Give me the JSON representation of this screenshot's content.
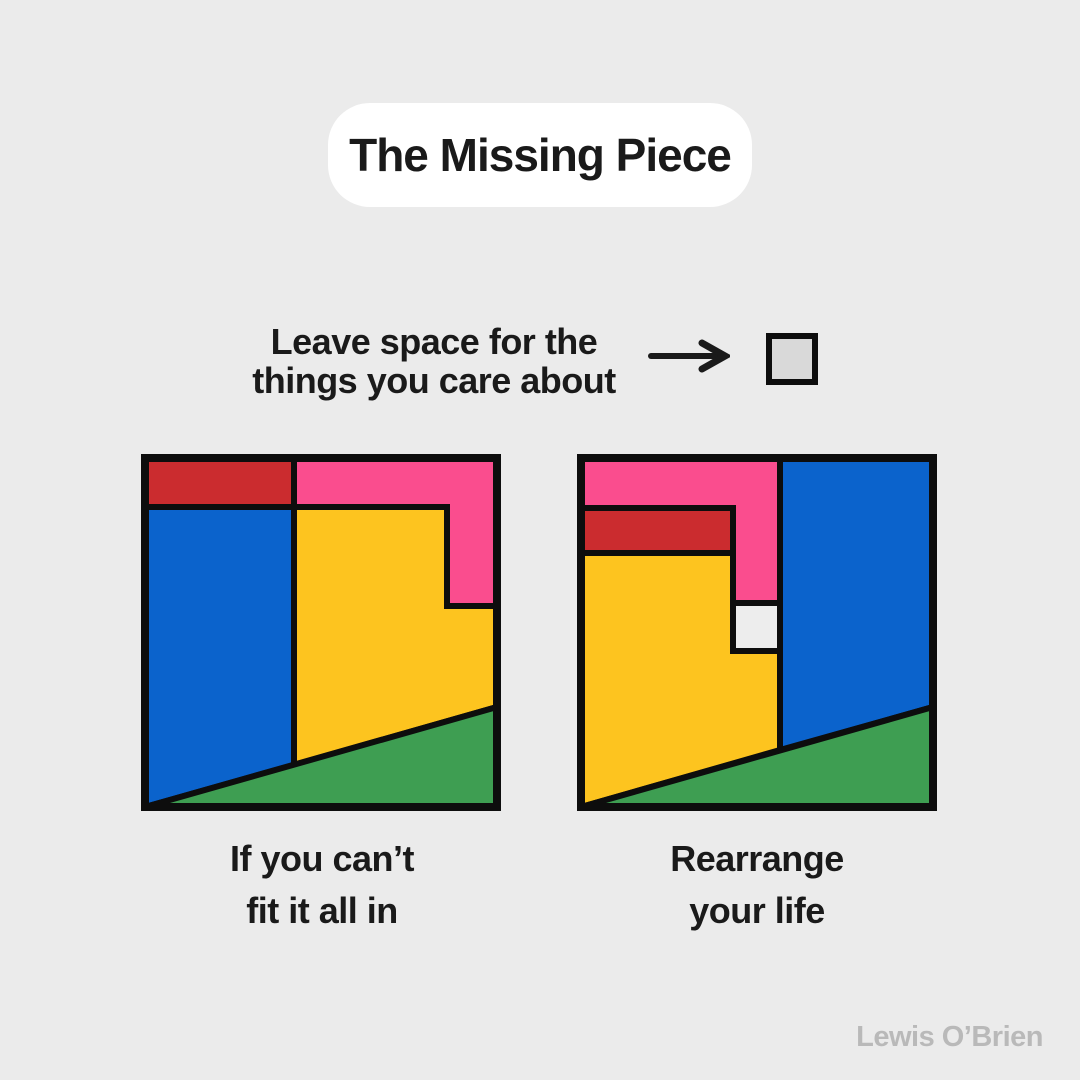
{
  "title": "The Missing Piece",
  "instruction": {
    "line1": "Leave space for the",
    "line2": "things you care about"
  },
  "panels": {
    "left": {
      "caption_line1": "If you can’t",
      "caption_line2": "fit it all in"
    },
    "right": {
      "caption_line1": "Rearrange",
      "caption_line2": "your life"
    }
  },
  "signature": "Lewis O’Brien",
  "palette": {
    "background": "#ebebeb",
    "card": "#ffffff",
    "ink": "#1a1a1a",
    "outline": "#0d0d0d",
    "red": "#cb2c2f",
    "pink": "#fa4d8e",
    "blue": "#0b63cc",
    "yellow": "#fdc41f",
    "green": "#3e9e52",
    "missing_piece": "#d9d9d9",
    "missing_slot": "#ededed",
    "signature_gray": "#b9b9b9"
  }
}
